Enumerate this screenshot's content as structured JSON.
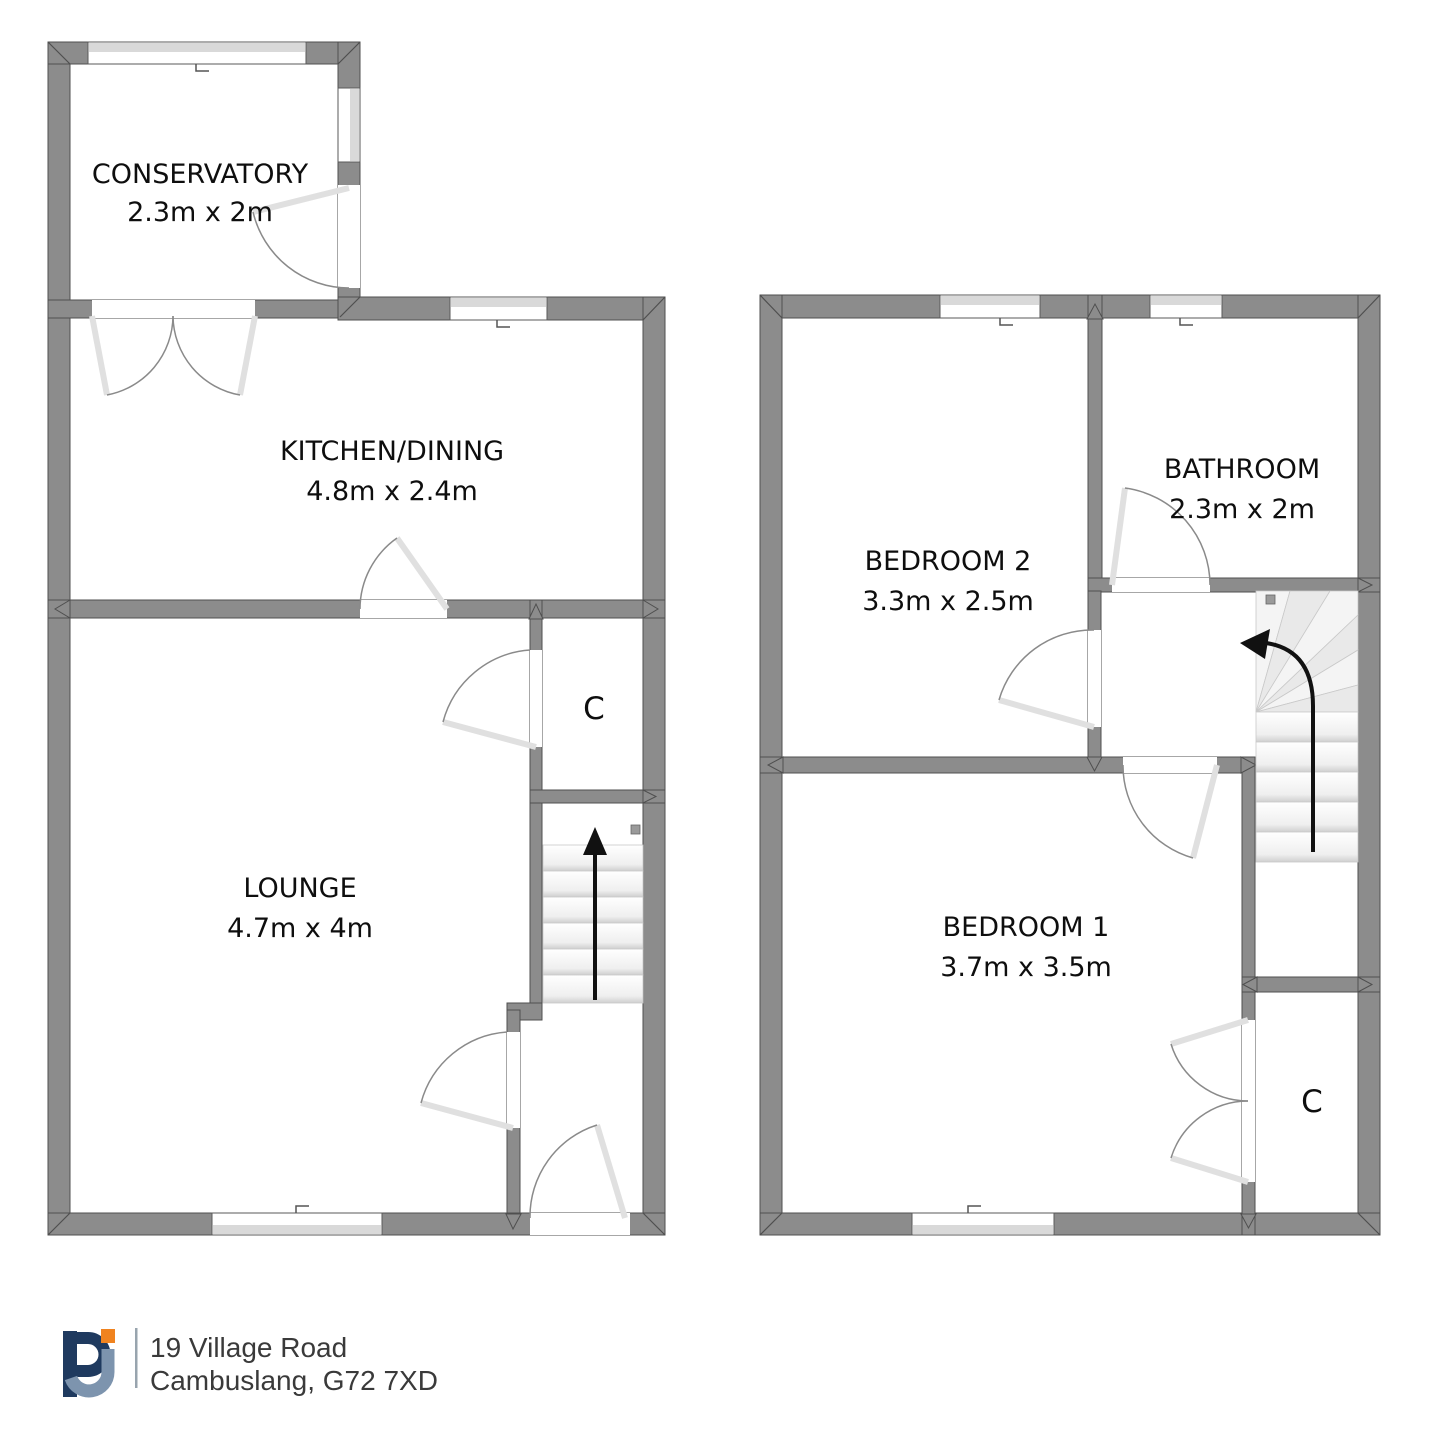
{
  "title": "Two storey house floorplan",
  "ground_floor": {
    "conservatory": {
      "name": "CONSERVATORY",
      "dims": "2.3m x 2m"
    },
    "kitchen_dining": {
      "name": "KITCHEN/DINING",
      "dims": "4.8m x 2.4m"
    },
    "lounge": {
      "name": "LOUNGE",
      "dims": "4.7m x 4m"
    },
    "closet": {
      "label": "C"
    },
    "stairs": {
      "arrow_icon": "up-arrow"
    }
  },
  "first_floor": {
    "bedroom2": {
      "name": "BEDROOM 2",
      "dims": "3.3m x 2.5m"
    },
    "bathroom": {
      "name": "BATHROOM",
      "dims": "2.3m x 2m"
    },
    "bedroom1": {
      "name": "BEDROOM 1",
      "dims": "3.7m x 3.5m"
    },
    "closet": {
      "label": "C"
    },
    "stairs": {
      "arrow_icon": "curved-left-arrow"
    }
  },
  "footer": {
    "logo_text": "PJ",
    "address_line1": "19 Village Road",
    "address_line2": "Cambuslang, G72 7XD"
  },
  "colors": {
    "wall": "#8c8c8c",
    "wall_outline": "#4f4f4f",
    "window_band": "#d9d9d9",
    "door_arc": "#8a8a8a",
    "door_leaf": "#e0e0e0",
    "label_text": "#0e0e0e",
    "address_text": "#3a3a3a",
    "logo_navy": "#1f3a5f",
    "logo_steel": "#7d94ae",
    "logo_orange": "#f0831f"
  }
}
